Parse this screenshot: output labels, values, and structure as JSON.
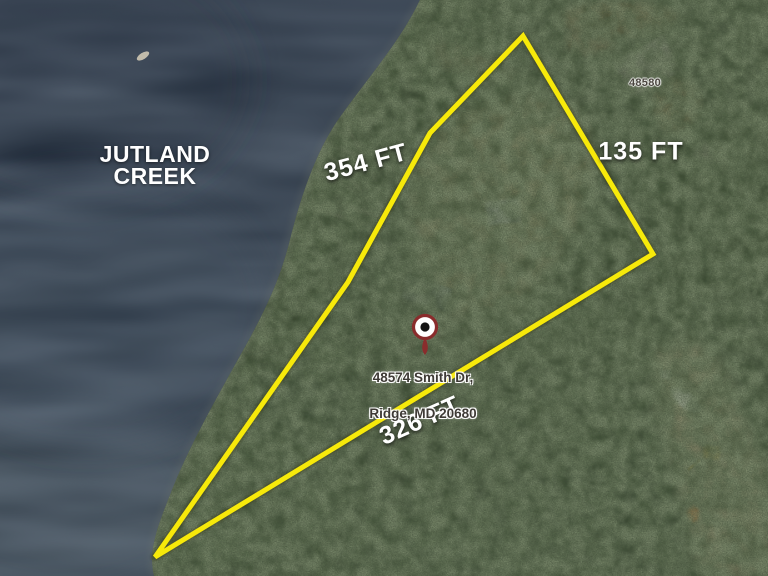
{
  "map": {
    "water_label": "JUTLAND\nCREEK",
    "parcel_number": "48580",
    "marker": {
      "address_line1": "48574 Smith Dr,",
      "address_line2": "Ridge, MD 20680"
    },
    "measurements": [
      {
        "side": "upper-left-boundary",
        "label": "354 FT"
      },
      {
        "side": "right-boundary",
        "label": "135 FT"
      },
      {
        "side": "bottom-boundary",
        "label": "326 FT"
      }
    ],
    "colors": {
      "boundary": "#f7e90a",
      "water": "#26303e",
      "pin_ring": "#8a2c2c",
      "measurement_text": "#ffffff"
    }
  }
}
